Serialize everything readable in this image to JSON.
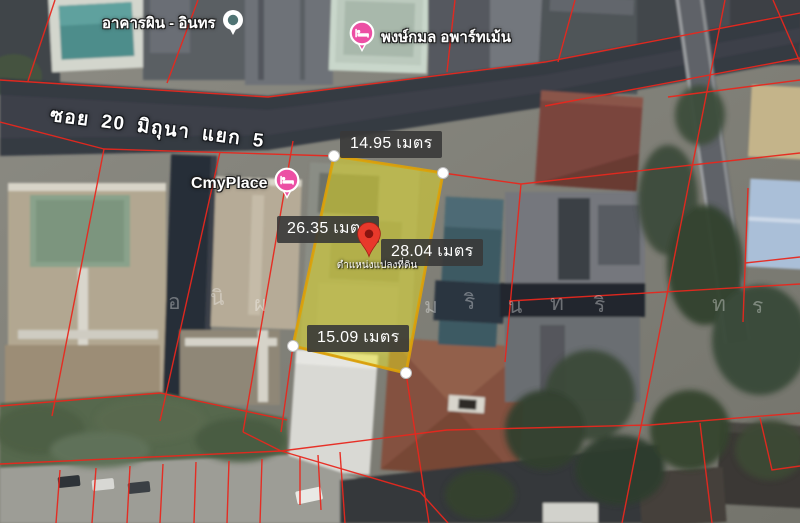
{
  "street": {
    "name": "ซอย 20 มิถุนา แยก 5"
  },
  "places": {
    "building": {
      "name": "อาคารผิน - อินทร",
      "icon": "generic-poi-pin"
    },
    "apartment": {
      "name": "พงษ์กมล อพาร์ทเม้น",
      "icon": "lodging-pin"
    },
    "cmyplace": {
      "name": "CmyPlace",
      "icon": "lodging-pin"
    }
  },
  "parcel": {
    "width_top": "14.95 เมตร",
    "side_left": "26.35 เมตร",
    "side_right": "28.04 เมตร",
    "width_bottom": "15.09 เมตร",
    "pin_caption": "ตำแหน่งแปลงที่ดิน",
    "highlight_fill": "#e8e020",
    "border_color": "#d9a50b"
  },
  "watermark": [
    {
      "ch": "อ"
    },
    {
      "ch": "นิ"
    },
    {
      "ch": "ผ"
    },
    {
      "ch": "ม"
    },
    {
      "ch": "ริ"
    },
    {
      "ch": "น"
    },
    {
      "ch": "ท"
    },
    {
      "ch": "ริ"
    },
    {
      "ch": "ท"
    },
    {
      "ch": "ร"
    }
  ],
  "colors": {
    "cadastral_line": "#e8281e",
    "badge_background": "#383838",
    "badge_text": "#ffffff",
    "location_pin": "#e8392b",
    "lodging_pin": "#ec4fa4",
    "poi_pin_dot": "#507474"
  }
}
